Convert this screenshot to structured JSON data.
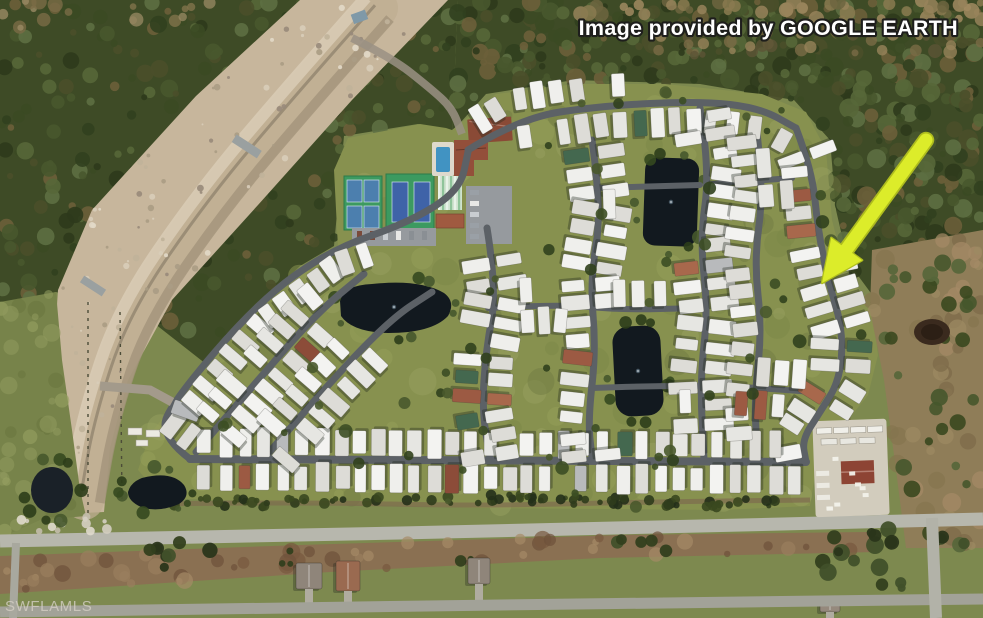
{
  "overlay": {
    "attribution": {
      "text": "Image provided by GOOGLE EARTH",
      "color": "#ffffff",
      "outline_color": "#1e1e1c"
    },
    "watermark": {
      "text": "SWFLAMLS",
      "color": "#d6d0c6"
    },
    "arrow": {
      "color": "#dcec2a",
      "edge_color": "#aebc1e",
      "tail": [
        926,
        140
      ],
      "tip": [
        822,
        283
      ]
    }
  },
  "scene": {
    "type": "aerial-photo",
    "features": [
      "mobile-home-community",
      "curved-residential-streets",
      "mobile-homes",
      "retention-ponds",
      "tennis-courts",
      "swimming-pool",
      "clubhouse",
      "shuffleboard-courts",
      "parking-lots",
      "rv-boat-storage-yard",
      "construction-road-corridor",
      "woodland",
      "scrub-field",
      "grass-field",
      "boundary-roads",
      "single-family-houses"
    ],
    "palette": {
      "grass_base": "#7d894f",
      "grass_light": "#96a05b",
      "grass_dark": "#6e7a41",
      "woods_base": "#3e4b26",
      "corridor": "#c7b69c",
      "street": "#5c6166",
      "road_light": "#b7b7ad",
      "road_mid": "#a2a298",
      "dirt": "#8a7052",
      "scrub": "#8f7d58",
      "pond": "#12191f",
      "home_white": "#eaeae7",
      "home_gray": "#b8babc",
      "home_terracotta": "#9c5a43",
      "home_green": "#44684f",
      "tennis_pad": "#3c9a60",
      "tennis_court": "#3f63a8",
      "pool": "#4193c2",
      "clubhouse_roof": "#8a4a36",
      "concrete": "#d2ccbd"
    }
  }
}
